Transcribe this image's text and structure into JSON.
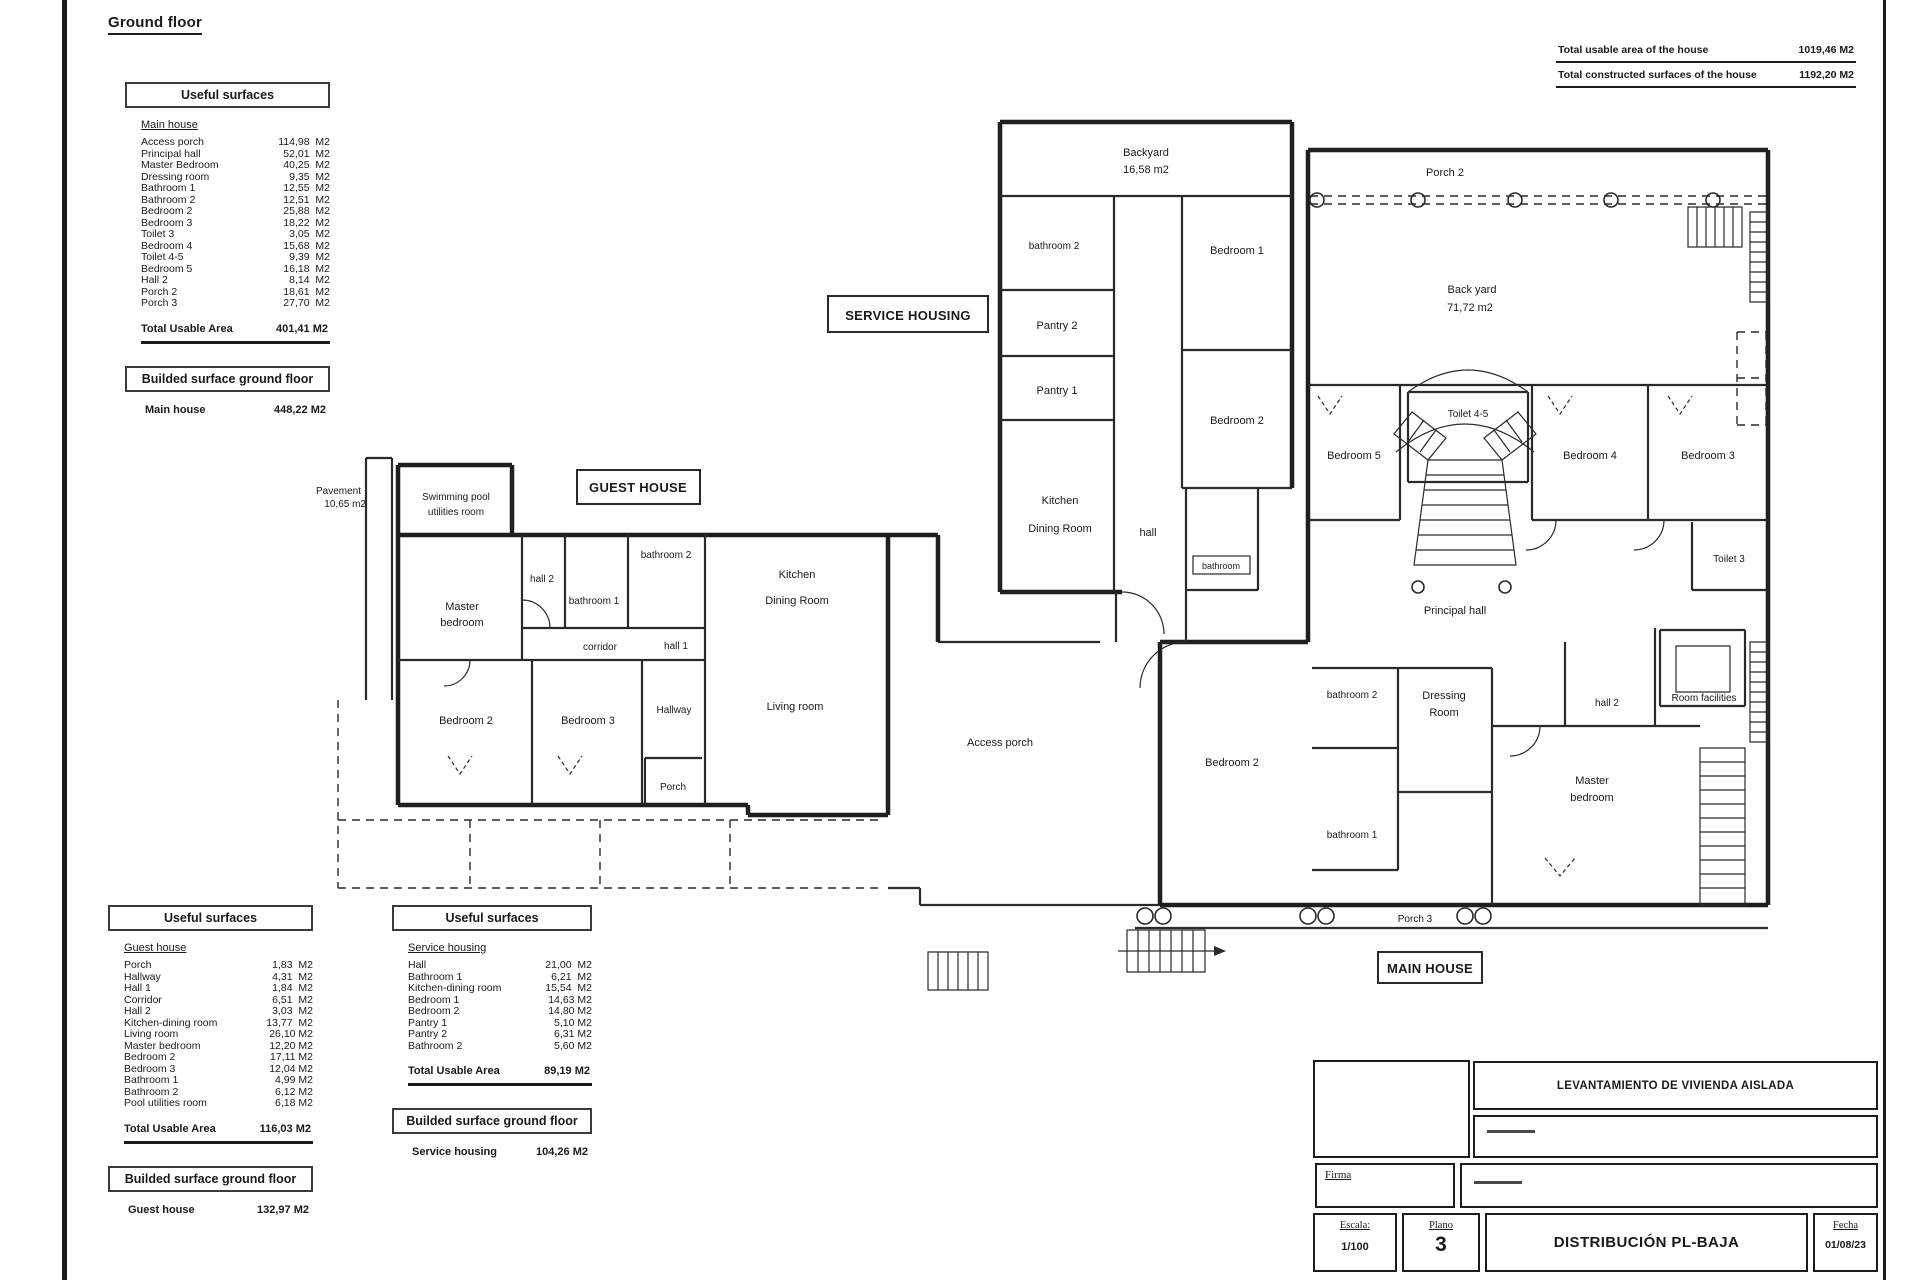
{
  "sheet": {
    "title": "Ground floor"
  },
  "totals": [
    {
      "label": "Total usable area of the house",
      "value": "1019,46 M2"
    },
    {
      "label": "Total constructed surfaces of the house",
      "value": "1192,20 M2"
    }
  ],
  "tables": {
    "useful_header": "Useful surfaces",
    "built_header": "Builded surface ground floor",
    "total_label": "Total Usable Area",
    "main_house": {
      "group": "Main house",
      "rows": [
        [
          "Access porch",
          "114,98  M2"
        ],
        [
          "Principal hall",
          "52,01  M2"
        ],
        [
          "Master Bedroom",
          "40,25  M2"
        ],
        [
          "Dressing room",
          "9,35  M2"
        ],
        [
          "Bathroom 1",
          "12,55  M2"
        ],
        [
          "Bathroom 2",
          "12,51  M2"
        ],
        [
          "Bedroom 2",
          "25,88  M2"
        ],
        [
          "Bedroom 3",
          "18,22  M2"
        ],
        [
          "Toilet 3",
          "3,05  M2"
        ],
        [
          "Bedroom 4",
          "15,68  M2"
        ],
        [
          "Toilet 4-5",
          "9,39  M2"
        ],
        [
          "Bedroom 5",
          "16,18  M2"
        ],
        [
          "Hall 2",
          "8,14  M2"
        ],
        [
          "Porch 2",
          "18,61  M2"
        ],
        [
          "Porch 3",
          "27,70  M2"
        ]
      ],
      "total": "401,41 M2",
      "built_label": "Main house",
      "built_value": "448,22 M2"
    },
    "guest_house": {
      "group": "Guest house",
      "rows": [
        [
          "Porch",
          "1,83  M2"
        ],
        [
          "Hallway",
          "4,31  M2"
        ],
        [
          "Hall 1",
          "1,84  M2"
        ],
        [
          "Corridor",
          "6,51  M2"
        ],
        [
          "Hall 2",
          "3,03  M2"
        ],
        [
          "Kitchen-dining room",
          "13,77  M2"
        ],
        [
          "Living room",
          "26,10 M2"
        ],
        [
          "Master bedroom",
          "12,20 M2"
        ],
        [
          "Bedroom 2",
          "17,11 M2"
        ],
        [
          "Bedroom 3",
          "12,04 M2"
        ],
        [
          "Bathroom 1",
          "4,99 M2"
        ],
        [
          "Bathroom 2",
          "6,12 M2"
        ],
        [
          "Pool utilities room",
          "6,18 M2"
        ]
      ],
      "total": "116,03 M2",
      "built_label": "Guest house",
      "built_value": "132,97 M2"
    },
    "service_housing": {
      "group": "Service housing",
      "rows": [
        [
          "Hall",
          "21,00  M2"
        ],
        [
          "Bathroom 1",
          "6,21  M2"
        ],
        [
          "Kitchen-dining room",
          "15,54  M2"
        ],
        [
          "Bedroom 1",
          "14,63 M2"
        ],
        [
          "Bedroom 2",
          "14,80 M2"
        ],
        [
          "Pantry 1",
          "5,10 M2"
        ],
        [
          "Pantry 2",
          "6,31 M2"
        ],
        [
          "Bathroom 2",
          "5,60 M2"
        ]
      ],
      "total": "89,19 M2",
      "built_label": "Service housing",
      "built_value": "104,26 M2"
    }
  },
  "plan": {
    "blocks": {
      "service": "SERVICE HOUSING",
      "guest": "GUEST HOUSE",
      "main": "MAIN HOUSE"
    },
    "labels": {
      "backyard1": "Backyard",
      "backyard2": "16,58 m2",
      "sh_bathroom2": "bathroom 2",
      "sh_pantry2": "Pantry 2",
      "sh_pantry1": "Pantry 1",
      "sh_kitchen1": "Kitchen",
      "sh_kitchen2": "Dining Room",
      "sh_bedroom1": "Bedroom 1",
      "sh_bedroom2": "Bedroom 2",
      "sh_hall": "hall",
      "sh_bathroom": "bathroom",
      "mh_porch2": "Porch 2",
      "mh_backyard1": "Back yard",
      "mh_backyard2": "71,72 m2",
      "mh_bedroom5": "Bedroom 5",
      "mh_toilet45": "Toilet 4-5",
      "mh_bedroom4": "Bedroom 4",
      "mh_bedroom3": "Bedroom 3",
      "mh_toilet3": "Toilet 3",
      "mh_principal_hall": "Principal hall",
      "mh_room_facilities": "Room facilities",
      "mh_hall2": "hall 2",
      "mh_dressing1": "Dressing",
      "mh_dressing2": "Room",
      "mh_bathroom2": "bathroom 2",
      "mh_bathroom1": "bathroom 1",
      "mh_bedroom2": "Bedroom 2",
      "mh_master1": "Master",
      "mh_master2": "bedroom",
      "mh_porch3": "Porch 3",
      "mh_access_porch": "Access porch",
      "gh_pavement1": "Pavement",
      "gh_pavement2": "10,65 m2",
      "gh_pool1": "Swimming pool",
      "gh_pool2": "utilities room",
      "gh_hall2": "hall 2",
      "gh_master1": "Master",
      "gh_master2": "bedroom",
      "gh_bathroom1": "bathroom 1",
      "gh_bathroom2": "bathroom 2",
      "gh_corridor": "corridor",
      "gh_hall1": "hall 1",
      "gh_bedroom2": "Bedroom 2",
      "gh_bedroom3": "Bedroom 3",
      "gh_hallway": "Hallway",
      "gh_porch": "Porch",
      "gh_kitchen1": "Kitchen",
      "gh_kitchen2": "Dining Room",
      "gh_living": "Living room"
    }
  },
  "titleblock": {
    "project": "LEVANTAMIENTO DE VIVIENDA AISLADA",
    "firma": "Firma",
    "escala_label": "Escala:",
    "escala_value": "1/100",
    "plano_label": "Plano",
    "plano_value": "3",
    "drawing": "DISTRIBUCIÓN PL-BAJA",
    "fecha_label": "Fecha",
    "fecha_value": "01/08/23"
  }
}
